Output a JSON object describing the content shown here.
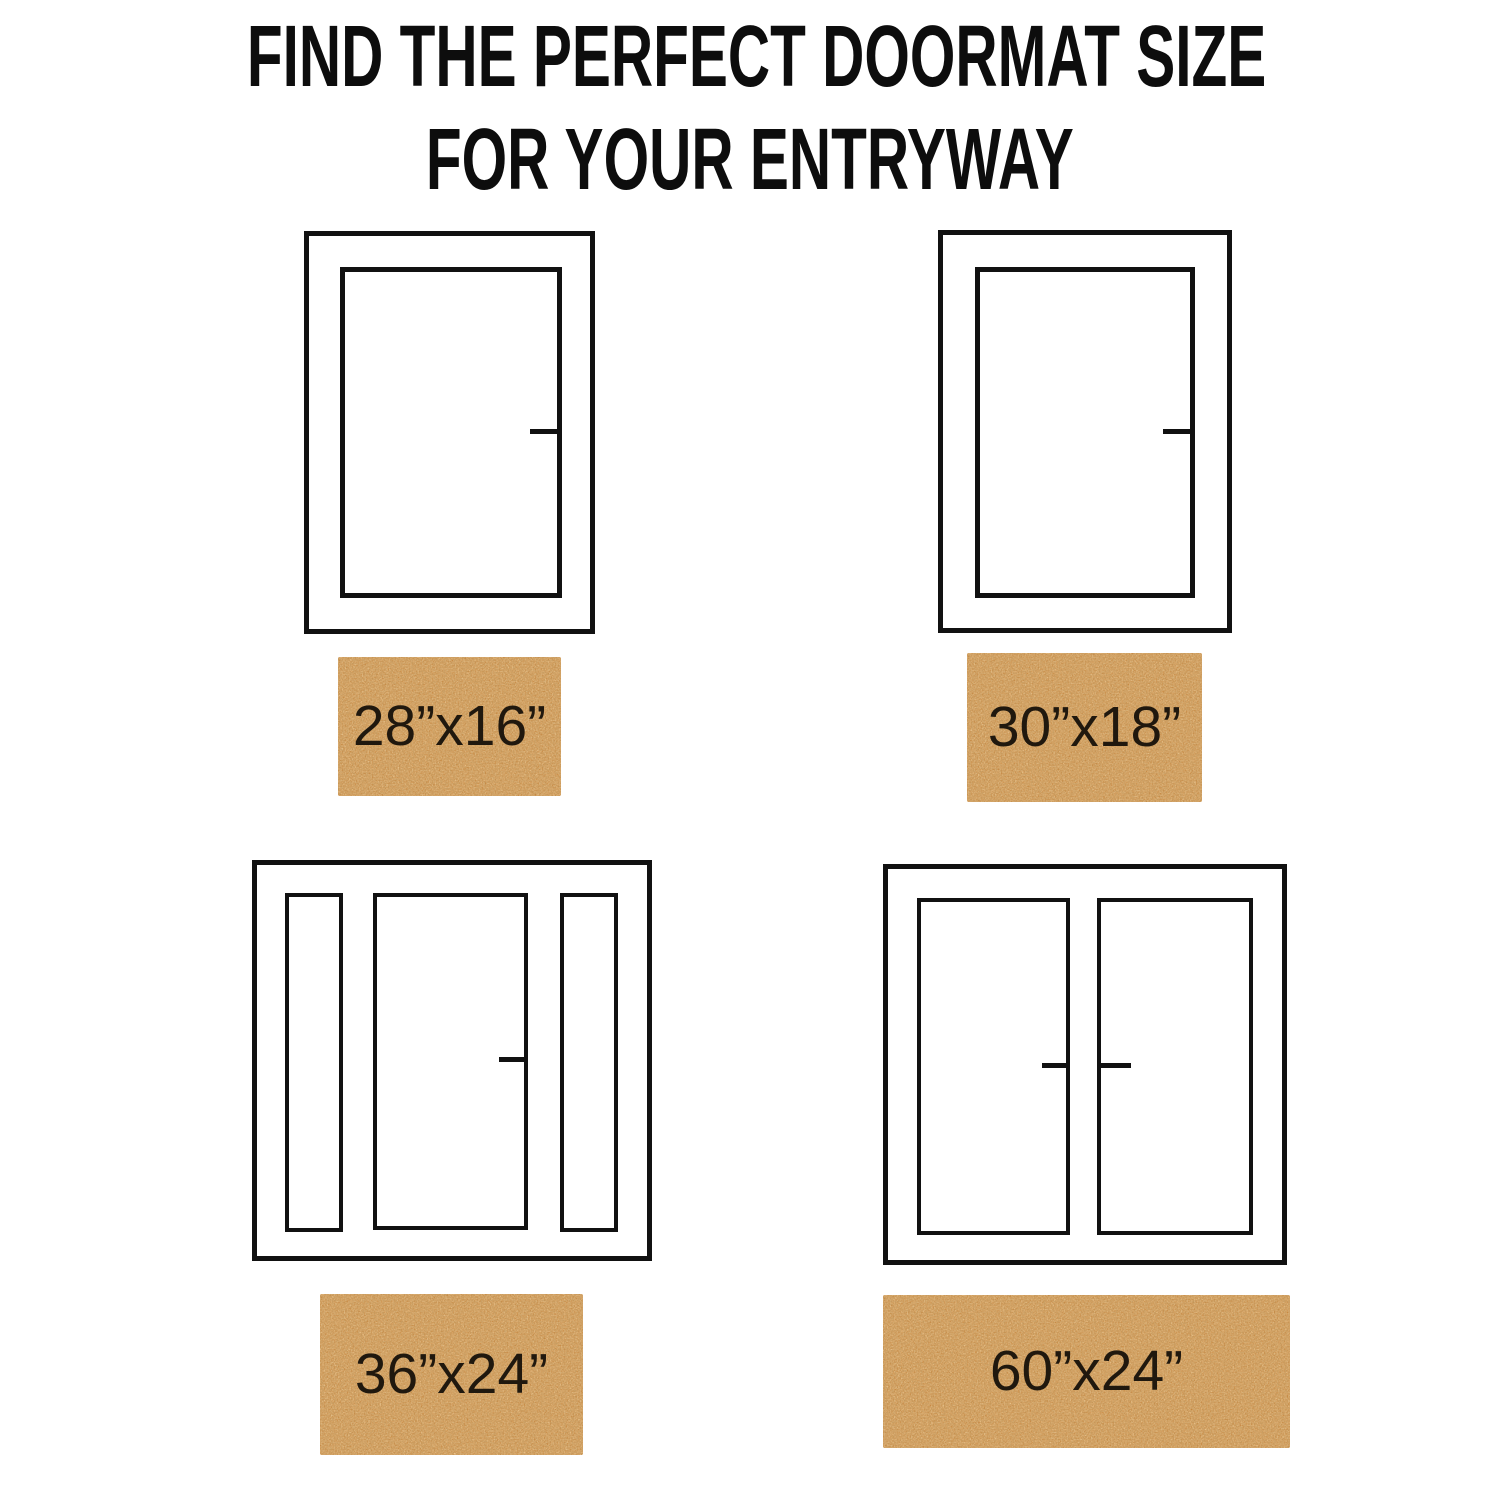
{
  "title": {
    "line1": "FIND THE PERFECT DOORMAT SIZE",
    "line2": "FOR YOUR ENTRYWAY"
  },
  "doors": [
    {
      "name": "single-door",
      "position": "top-left"
    },
    {
      "name": "single-door",
      "position": "top-right"
    },
    {
      "name": "door-with-sidelights",
      "position": "bottom-left"
    },
    {
      "name": "double-door",
      "position": "bottom-right"
    }
  ],
  "mats": [
    {
      "size_label": "28”x16”"
    },
    {
      "size_label": "30”x18”"
    },
    {
      "size_label": "36”x24”"
    },
    {
      "size_label": "60”x24”"
    }
  ],
  "colors": {
    "background": "#ffffff",
    "line": "#111111",
    "title_text": "#0d0d0d",
    "mat_base": "#c5843c",
    "mat_speckle_light": "#dea055",
    "mat_speckle_dark": "#8c581e",
    "mat_text": "#20180e"
  }
}
